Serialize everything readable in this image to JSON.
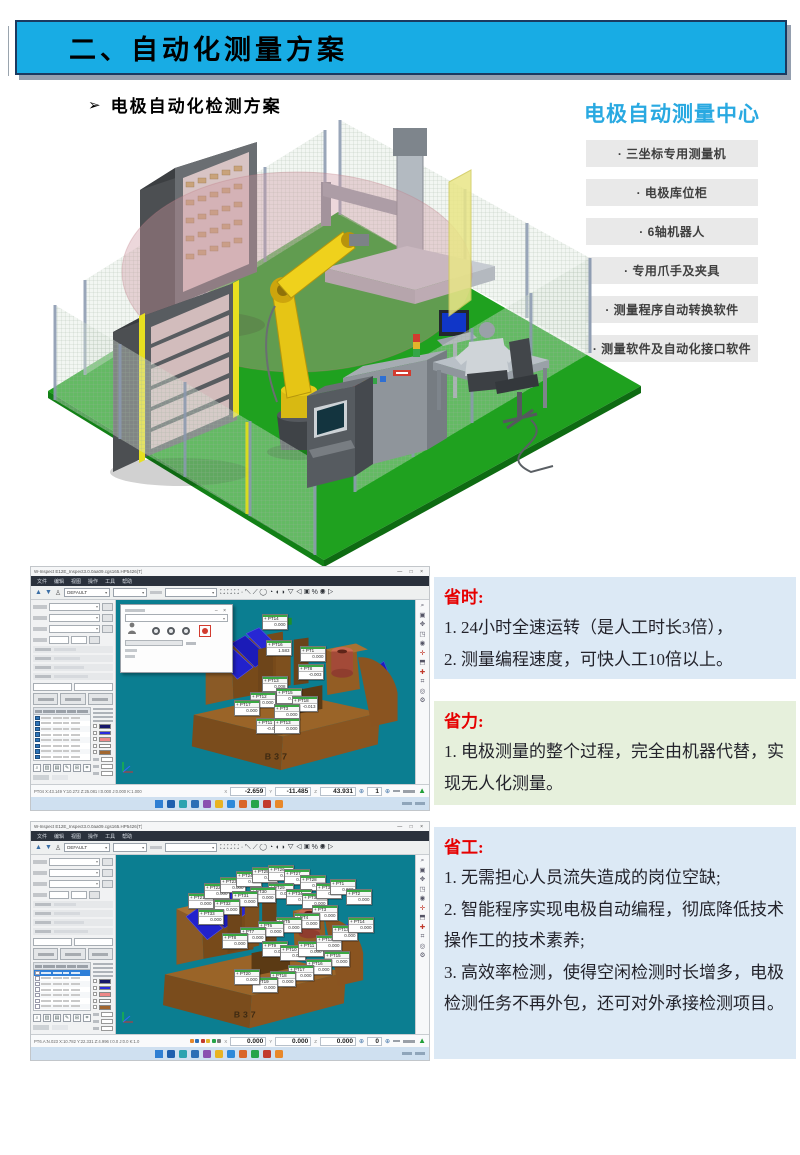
{
  "header": {
    "title": "二、自动化测量方案"
  },
  "subheading": {
    "bullet": "➢",
    "label": "电极自动化检测方案"
  },
  "center": {
    "title": "电极自动测量中心",
    "items": [
      {
        "label": "· 三坐标专用测量机"
      },
      {
        "label": "· 电极库位柜"
      },
      {
        "label": "· 6轴机器人"
      },
      {
        "label": "· 专用爪手及夹具"
      },
      {
        "label": "· 测量程序自动转换软件"
      },
      {
        "label": "· 测量软件及自动化接口软件"
      }
    ]
  },
  "benefits": [
    {
      "title": "省时:",
      "lines": [
        "1. 24小时全速运转（是人工时长3倍），",
        "2. 测量编程速度，可快人工10倍以上。"
      ]
    },
    {
      "title": "省力:",
      "lines": [
        "1. 电极测量的整个过程，完全由机器代替，实现无人化测量。"
      ]
    },
    {
      "title": "省工:",
      "lines": [
        "1. 无需担心人员流失造成的岗位空缺;",
        "2. 智能程序实现电极自动编程，彻底降低技术操作工的技术素养;",
        "3. 高效率检测，使得空闲检测时长增多，电极检测任务不再外包，还可对外承接检测项目。"
      ]
    }
  ],
  "software": {
    "window_title": "W-Inspect   E12E_Inspect3.0.0aa09.cgs165.HP5426(T)",
    "window_controls": "—  □  ×",
    "menus": [
      "文件",
      "编辑",
      "视图",
      "操作",
      "工具",
      "帮助"
    ],
    "toolbar": {
      "combo1": "DEFAULT",
      "combo2": "",
      "combo3": ""
    },
    "right_strip_icons": [
      "zoom-icon",
      "fit-view-icon",
      "pan-icon",
      "rotate-icon",
      "shade-icon",
      "probe-icon",
      "section-icon",
      "align-icon",
      "report-icon",
      "target-icon",
      "gear-icon"
    ],
    "shots": [
      {
        "part_label": "B37",
        "status_left": "PT04  X:43.149 Y:10.272 Z:25.081  I:0.000 J:0.000 K:1.000",
        "status": {
          "x": "-2.659",
          "y": "-11.485",
          "z": "43.931",
          "count": "1"
        },
        "dialog": true,
        "rows": 26,
        "checked": true,
        "mid_icons": false,
        "labels": [
          [
            "PT14",
            146,
            14
          ],
          [
            "PT16",
            150,
            40,
            "1.583"
          ],
          [
            "PT1",
            184,
            46
          ],
          [
            "PT8",
            182,
            64,
            "-0.003"
          ],
          [
            "PT13",
            146,
            76,
            "0.008"
          ],
          [
            "PT15",
            160,
            88
          ],
          [
            "PT12",
            134,
            92
          ],
          [
            "PT17",
            118,
            100
          ],
          [
            "PT18",
            176,
            96,
            "-0.013"
          ],
          [
            "PT3",
            158,
            104
          ],
          [
            "PT11",
            140,
            118,
            "-0.003"
          ],
          [
            "PT13",
            158,
            118
          ]
        ]
      },
      {
        "part_label": "B37",
        "status_left": "PT6.A:N.023  X:10.782 Y:22.331 Z:4.996  I:0.0 J:0.0 K:1.0",
        "status": {
          "x": "0.000",
          "y": "0.000",
          "z": "0.000",
          "count": "0"
        },
        "dialog": false,
        "rows": 28,
        "checked": false,
        "mid_icons": true,
        "labels": [
          [
            "PT21",
            72,
            38
          ],
          [
            "PT22",
            88,
            28
          ],
          [
            "PT23",
            104,
            22
          ],
          [
            "PT24",
            120,
            16
          ],
          [
            "PT25",
            136,
            12
          ],
          [
            "PT26",
            152,
            10
          ],
          [
            "PT27",
            168,
            14
          ],
          [
            "PT28",
            184,
            20
          ],
          [
            "PT29",
            152,
            28
          ],
          [
            "PT30",
            134,
            32
          ],
          [
            "PT31",
            116,
            36
          ],
          [
            "PT32",
            98,
            44
          ],
          [
            "PT33",
            82,
            54
          ],
          [
            "PT34",
            170,
            34
          ],
          [
            "PT35",
            186,
            38
          ],
          [
            "PT36",
            200,
            28
          ],
          [
            "PT1",
            214,
            24
          ],
          [
            "PT2",
            230,
            34
          ],
          [
            "PT3",
            196,
            50
          ],
          [
            "PT4",
            178,
            58
          ],
          [
            "PT5",
            160,
            62
          ],
          [
            "PT6",
            142,
            66
          ],
          [
            "PT7",
            124,
            72
          ],
          [
            "PT8",
            106,
            78
          ],
          [
            "PT9",
            146,
            86
          ],
          [
            "PT10",
            164,
            90
          ],
          [
            "PT11",
            182,
            86
          ],
          [
            "PT12",
            200,
            80
          ],
          [
            "PT13",
            216,
            70
          ],
          [
            "PT14",
            232,
            62
          ],
          [
            "PT15",
            208,
            96
          ],
          [
            "PT16",
            190,
            104
          ],
          [
            "PT17",
            172,
            110
          ],
          [
            "PT18",
            154,
            116
          ],
          [
            "PT19",
            136,
            122
          ],
          [
            "PT20",
            118,
            114
          ]
        ]
      }
    ],
    "taskbar_icon_colors": [
      "#2f7fd3",
      "#1e5fae",
      "#2aa3b0",
      "#2d6fb5",
      "#8a4fb0",
      "#e8b322",
      "#2c89d9",
      "#d9662b",
      "#27a44a",
      "#c23b2e",
      "#e8882a"
    ],
    "swatches": [
      "#16166a",
      "#2a2ae0",
      "#ee8888",
      "#ffffff",
      "#a2662e"
    ]
  },
  "colors": {
    "accent_blue": "#18ace4",
    "title_blue": "#29a9e1",
    "benefit_blue_bg": "#dce9f5",
    "benefit_green_bg": "#e6f0dc",
    "benefit_title_red": "#e60000",
    "viewport_teal": "#0b7e91",
    "floor_green": "#1fa11f"
  }
}
